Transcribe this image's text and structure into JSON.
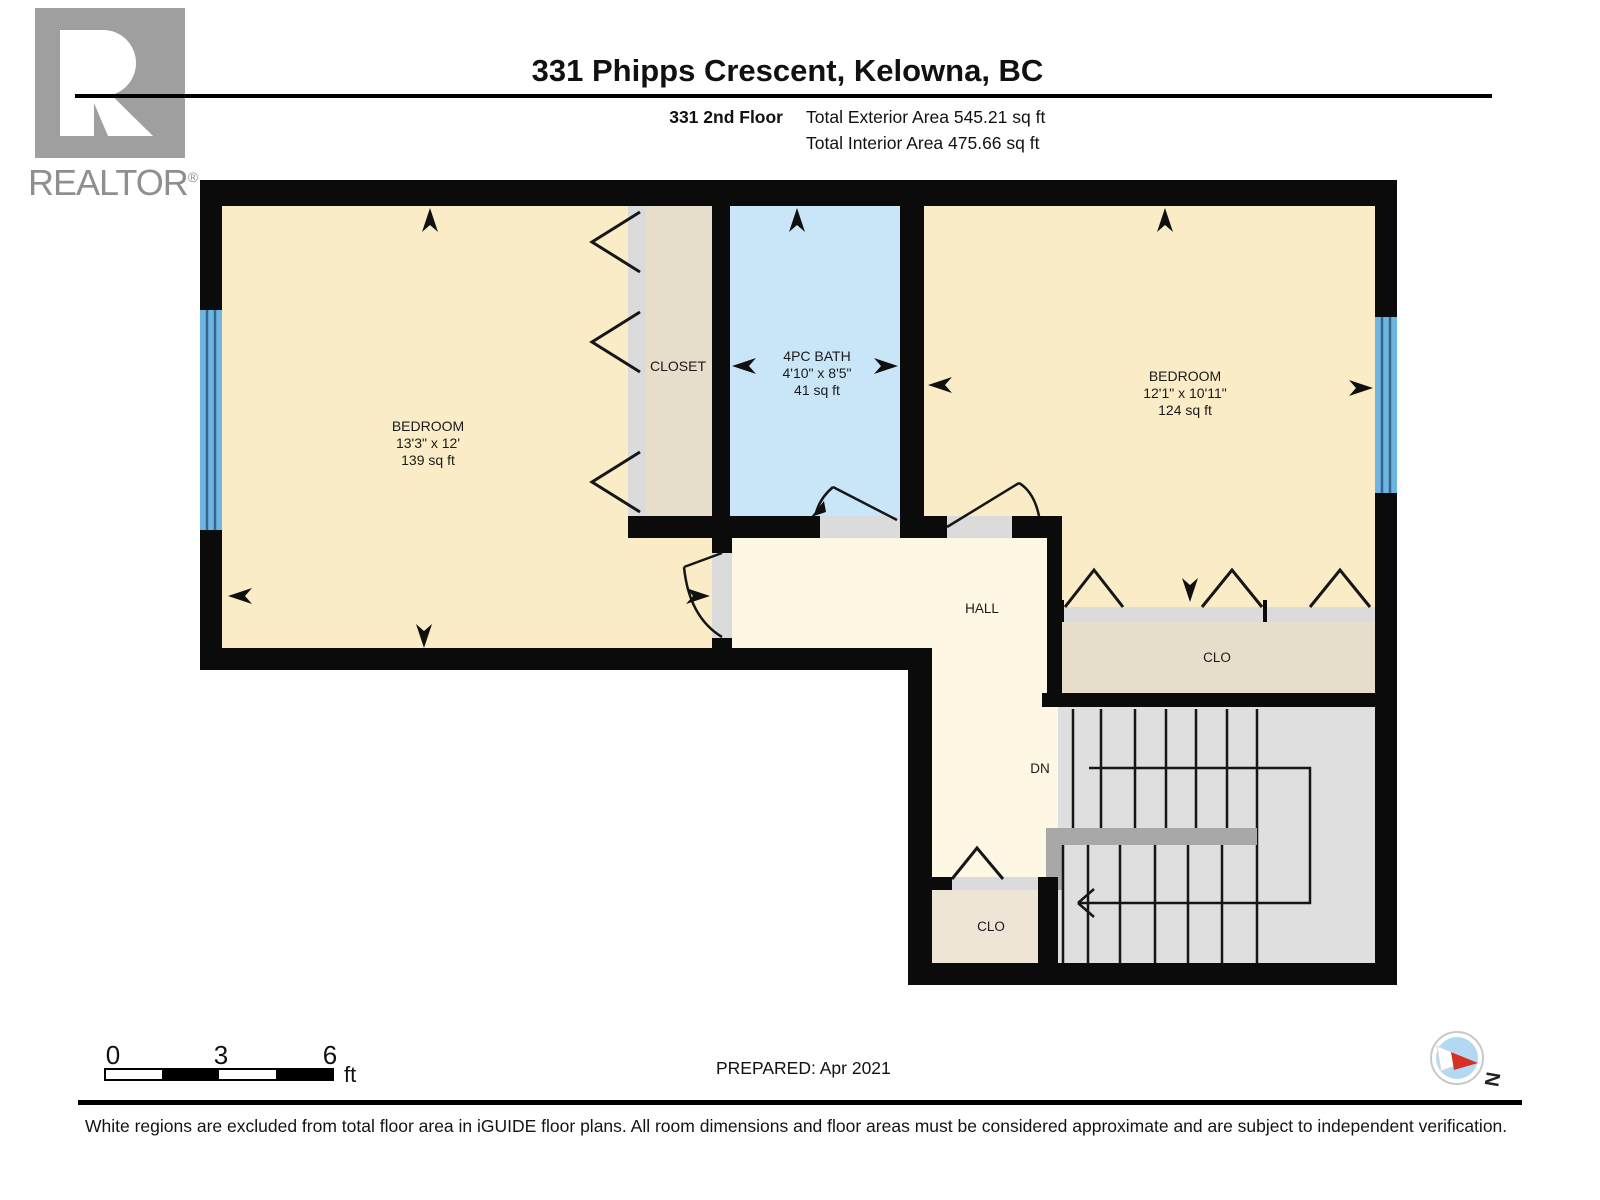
{
  "header": {
    "title": "331 Phipps Crescent, Kelowna, BC",
    "floor_label": "331 2nd Floor",
    "total_exterior": "Total Exterior Area 545.21 sq ft",
    "total_interior": "Total Interior Area 475.66 sq ft"
  },
  "logo": {
    "brand": "REALTOR",
    "reg": "®"
  },
  "plan": {
    "bedroom_left": {
      "name": "BEDROOM",
      "dims": "13'3\" x 12'",
      "area": "139 sq ft"
    },
    "closet_left": {
      "name": "CLOSET"
    },
    "bath": {
      "name": "4PC BATH",
      "dims": "4'10\" x 8'5\"",
      "area": "41 sq ft"
    },
    "bedroom_right": {
      "name": "BEDROOM",
      "dims": "12'1\" x 10'11\"",
      "area": "124 sq ft"
    },
    "hall": {
      "name": "HALL"
    },
    "closet_right": {
      "name": "CLO"
    },
    "stairs_label": "DN",
    "closet_hall": {
      "name": "CLO"
    }
  },
  "scale_bar": {
    "ticks": [
      "0",
      "3",
      "6"
    ],
    "unit": "ft"
  },
  "compass": {
    "north": "N"
  },
  "footer": {
    "prepared": "PREPARED: Apr 2021",
    "disclaimer": "White regions are excluded from total floor area in iGUIDE floor plans. All room dimensions and floor areas must be considered approximate and are subject to independent verification."
  },
  "colors": {
    "wall": "#0b0b0b",
    "room-cream": "#faecc6",
    "room-hall": "#fdf7e3",
    "room-bath": "#c9e5f8",
    "room-closet": "#e7ddcb",
    "room-closet-light": "#efe5d6",
    "threshold": "#dbdbdb",
    "stair": "#dfdfdf",
    "stair-dark": "#a8a8a8",
    "window-blue": "#6fb5e2",
    "compass-blue": "#b3d9f2",
    "compass-red": "#d43227",
    "logo-gray": "#8f8f8f"
  }
}
